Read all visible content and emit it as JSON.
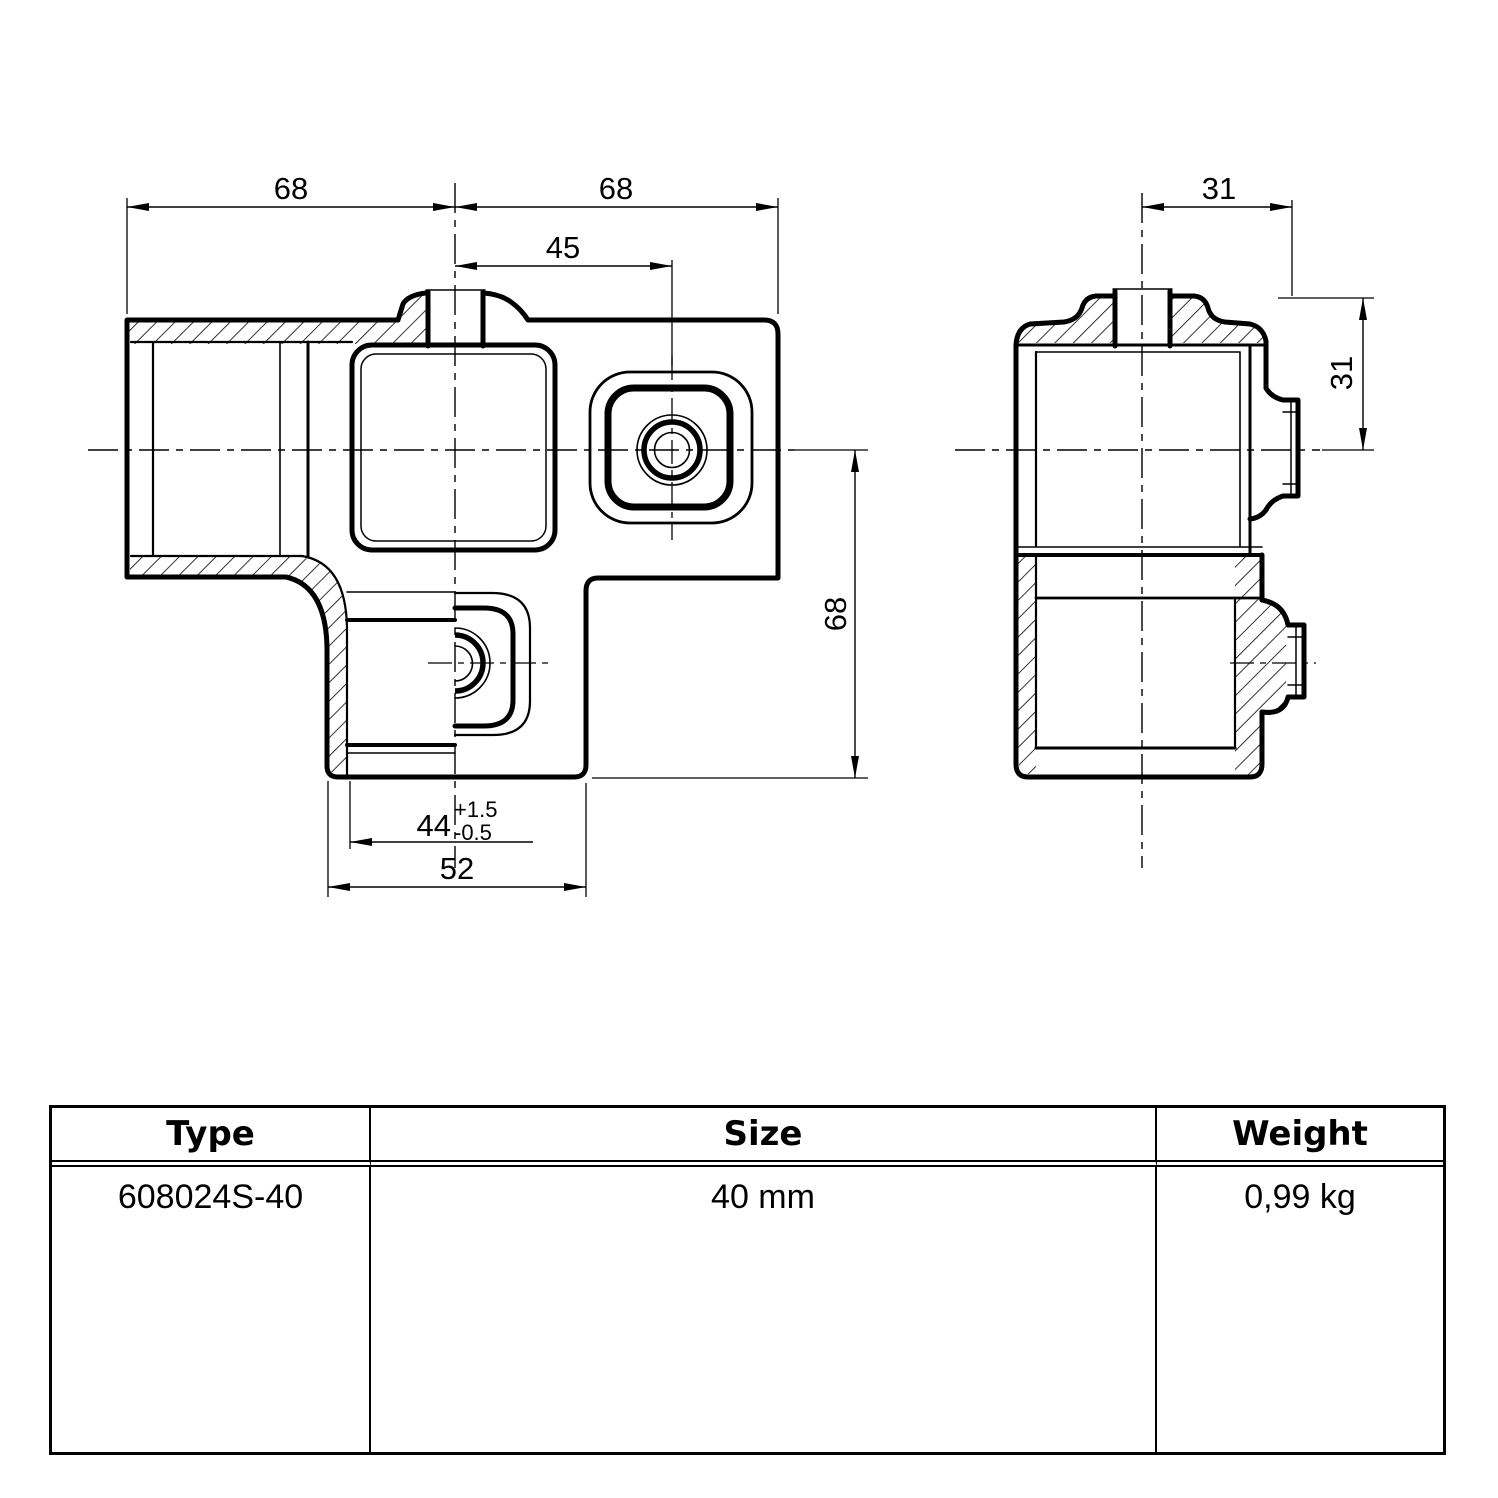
{
  "drawing": {
    "front_view": {
      "dim_width_left": "68",
      "dim_width_right": "68",
      "dim_socket_offset": "45",
      "dim_height": "68",
      "dim_bore": "44",
      "dim_bore_tol_plus": "+1.5",
      "dim_bore_tol_minus": "-0.5",
      "dim_socket_width": "52"
    },
    "side_view": {
      "dim_half_width": "31",
      "dim_boss_offset": "31"
    }
  },
  "table": {
    "headers": [
      "Type",
      "Size",
      "Weight"
    ],
    "rows": [
      [
        "608024S-40",
        "40 mm",
        "0,99 kg"
      ]
    ]
  }
}
